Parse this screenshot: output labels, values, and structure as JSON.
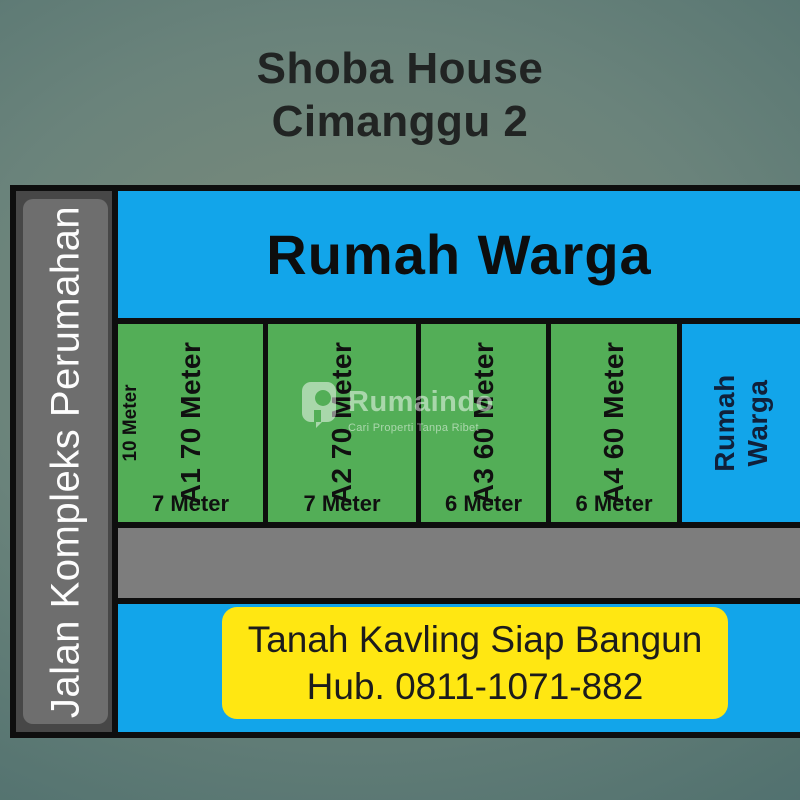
{
  "title": {
    "line1": "Shoba House",
    "line2": "Cimanggu 2"
  },
  "left_road": {
    "label": "Jalan Kompleks Perumahan"
  },
  "top_strip": {
    "label": "Rumah Warga"
  },
  "plots": [
    {
      "id": "A1",
      "label": "A1 70 Meter",
      "width_label": "7 Meter",
      "depth_label": "10 Meter"
    },
    {
      "id": "A2",
      "label": "A2 70 Meter",
      "width_label": "7 Meter"
    },
    {
      "id": "A3",
      "label": "A3 60 Meter",
      "width_label": "6 Meter"
    },
    {
      "id": "A4",
      "label": "A4 60 Meter",
      "width_label": "6 Meter"
    }
  ],
  "right_block": {
    "line1": "Rumah",
    "line2": "Warga"
  },
  "bottom_banner": {
    "line1": "Tanah Kavling Siap Bangun",
    "line2": "Hub. 0811-1071-882"
  },
  "watermark": {
    "name": "Rumaindo",
    "tagline": "Cari Properti Tanpa Ribet"
  },
  "colors": {
    "block_blue": "#12a5ea",
    "plot_green": "#53ae57",
    "banner_yellow": "#ffe712",
    "road_gray": "#7d7d7d",
    "side_road_dark": "#474747",
    "side_road_light": "#6e6e6e",
    "border_black": "#0e0e0e",
    "right_block_text_navy": "#10203a"
  }
}
